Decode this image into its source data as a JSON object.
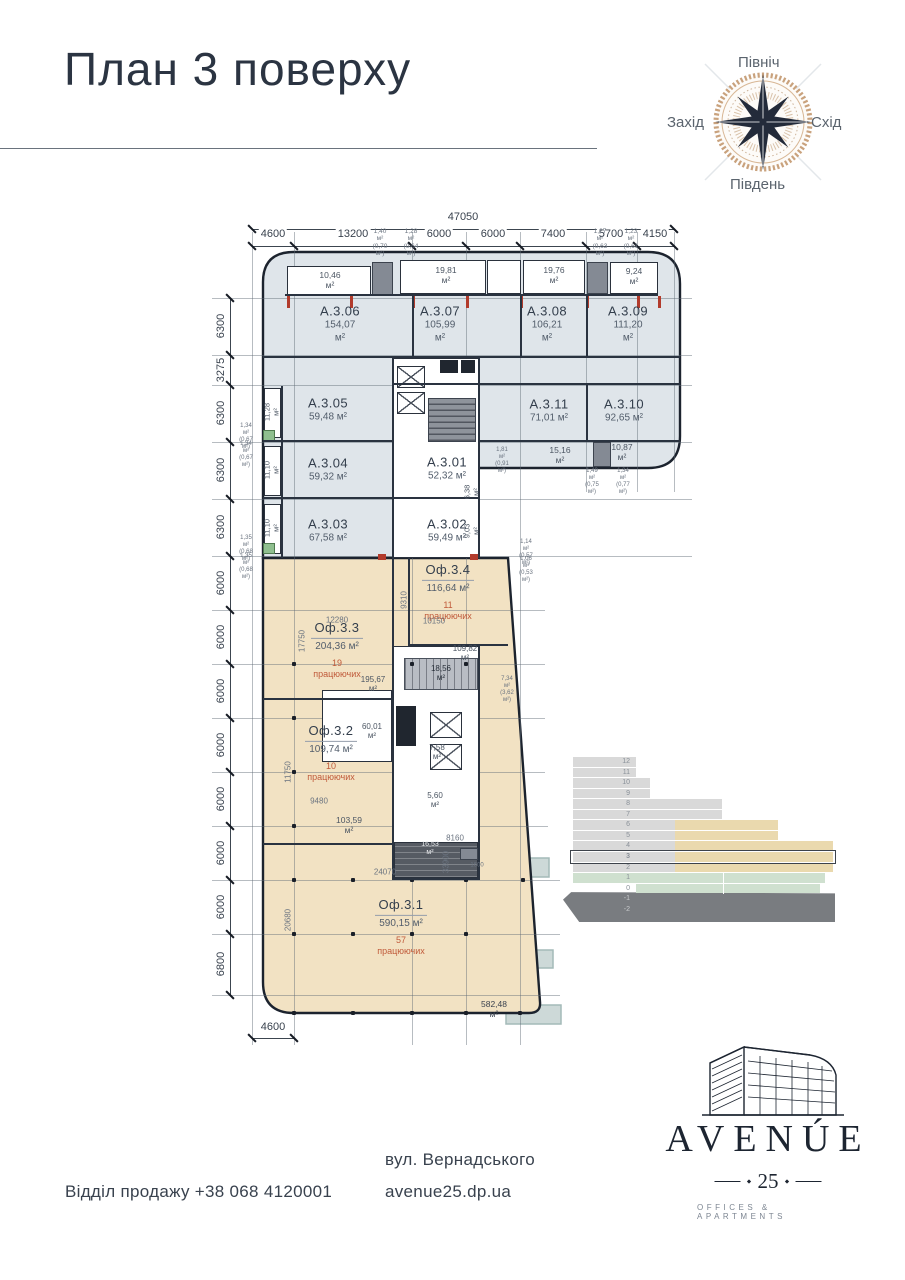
{
  "title": "План 3 поверху",
  "compass": {
    "north": "Північ",
    "south": "Південь",
    "west": "Захід",
    "east": "Схід"
  },
  "plan": {
    "total_width": "47050",
    "top_dims": [
      "4600",
      "13200",
      "6000",
      "6000",
      "7400",
      "5700",
      "4150"
    ],
    "left_dims": [
      "6300",
      "3275",
      "6300",
      "6300",
      "6300",
      "6000",
      "6000",
      "6000",
      "6000",
      "6000",
      "6000",
      "6000",
      "6800"
    ],
    "bottom_dim": "4600",
    "units": [
      {
        "id": "a306",
        "name": "А.3.06",
        "area": "154,07 м²"
      },
      {
        "id": "a307",
        "name": "А.3.07",
        "area": "105,99 м²"
      },
      {
        "id": "a308",
        "name": "А.3.08",
        "area": "106,21 м²"
      },
      {
        "id": "a309",
        "name": "А.3.09",
        "area": "111,20 м²"
      },
      {
        "id": "a305",
        "name": "А.3.05",
        "area": "59,48 м²"
      },
      {
        "id": "a311",
        "name": "А.3.11",
        "area": "71,01 м²"
      },
      {
        "id": "a310",
        "name": "А.3.10",
        "area": "92,65 м²"
      },
      {
        "id": "a304",
        "name": "А.3.04",
        "area": "59,32 м²"
      },
      {
        "id": "a301",
        "name": "А.3.01",
        "area": "52,32 м²"
      },
      {
        "id": "a303",
        "name": "А.3.03",
        "area": "67,58 м²"
      },
      {
        "id": "a302",
        "name": "А.3.02",
        "area": "59,49 м²"
      },
      {
        "id": "of34",
        "name": "Оф.3.4",
        "area": "116,64 м²",
        "workers": "11 працюючих"
      },
      {
        "id": "of33",
        "name": "Оф.3.3",
        "area": "204,36 м²",
        "workers": "19 працюючих"
      },
      {
        "id": "of32",
        "name": "Оф.3.2",
        "area": "109,74 м²",
        "workers": "10 працюючих"
      },
      {
        "id": "of31",
        "name": "Оф.3.1",
        "area": "590,15 м²",
        "workers": "57 працюючих"
      }
    ],
    "annotations": [
      {
        "id": "b1046",
        "text": "10,46 м²"
      },
      {
        "id": "b1981",
        "text": "19,81 м²"
      },
      {
        "id": "b1976",
        "text": "19,76 м²"
      },
      {
        "id": "b924",
        "text": "9,24 м²"
      },
      {
        "id": "t140",
        "text": "1,40 м²\n(0,70 м²)"
      },
      {
        "id": "t128",
        "text": "1,28 м²\n(0,64 м²)"
      },
      {
        "id": "t127",
        "text": "1,27 м²\n(0,63 м²)"
      },
      {
        "id": "t123",
        "text": "1,23 м²\n(0,61 м²)"
      },
      {
        "id": "v1128",
        "text": "11,28 м²"
      },
      {
        "id": "v1110a",
        "text": "11,10 м²"
      },
      {
        "id": "v1110b",
        "text": "11,10 м²"
      },
      {
        "id": "t134a",
        "text": "1,34 м²\n(0,67 м²)"
      },
      {
        "id": "t134b",
        "text": "1,34 м²\n(0,67 м²)"
      },
      {
        "id": "t135a",
        "text": "1,35 м²\n(0,68 м²)"
      },
      {
        "id": "t135b",
        "text": "1,35 м²\n(0,68 м²)"
      },
      {
        "id": "t181",
        "text": "1,81 м²\n(0,91 м²)"
      },
      {
        "id": "s1516",
        "text": "15,16 м²"
      },
      {
        "id": "s1087",
        "text": "10,87 м²"
      },
      {
        "id": "t149",
        "text": "1,49 м²\n(0,75 м²)"
      },
      {
        "id": "t134c",
        "text": "1,34 м²\n(0,77 м²)"
      },
      {
        "id": "v638",
        "text": "6,38 м²"
      },
      {
        "id": "v903",
        "text": "9,03 м²"
      },
      {
        "id": "t114",
        "text": "1,14 м²\n(0,57 м²)"
      },
      {
        "id": "t106",
        "text": "1,06 м²\n(0,53 м²)"
      },
      {
        "id": "d9310",
        "text": "9310"
      },
      {
        "id": "d12280",
        "text": "12280"
      },
      {
        "id": "d10150",
        "text": "10150"
      },
      {
        "id": "d17750",
        "text": "17750"
      },
      {
        "id": "r10982",
        "text": "109,82 м²"
      },
      {
        "id": "r1856",
        "text": "18,56 м²"
      },
      {
        "id": "r19567",
        "text": "195,67 м²"
      },
      {
        "id": "t734",
        "text": "7,34 м²\n(3,62 м²)"
      },
      {
        "id": "r6001",
        "text": "60,01 м²"
      },
      {
        "id": "r758",
        "text": "7,58 м²"
      },
      {
        "id": "d11750",
        "text": "11750"
      },
      {
        "id": "r560",
        "text": "5,60 м²"
      },
      {
        "id": "d9480",
        "text": "9480"
      },
      {
        "id": "r10359",
        "text": "103,59 м²"
      },
      {
        "id": "r1653",
        "text": "16,53 м²"
      },
      {
        "id": "d8160",
        "text": "8160"
      },
      {
        "id": "d1600",
        "text": "1600"
      },
      {
        "id": "d24070",
        "text": "24070"
      },
      {
        "id": "d33900",
        "text": "33900"
      },
      {
        "id": "d20680",
        "text": "20680"
      },
      {
        "id": "r58248",
        "text": "582,48 м²"
      }
    ]
  },
  "elevation": {
    "floor_labels": [
      "12",
      "11",
      "10",
      "9",
      "8",
      "7",
      "6",
      "5",
      "4",
      "3",
      "2",
      "1",
      "0",
      "-1",
      "-2"
    ],
    "highlighted_floor": "3"
  },
  "colors": {
    "apartments_fill": "#dfe5ea",
    "offices_fill": "#f2e2c3",
    "workers_red": "#c05a3a",
    "terrace_teal": "#cdd9d8",
    "elev_grey": "#d9d9d9",
    "elev_beige": "#ead9ae",
    "elev_green": "#cfe0cf"
  },
  "footer": {
    "phone": "Відділ продажу +38 068 4120001",
    "street": "вул. Вернадського",
    "site": "avenue25.dp.ua"
  },
  "logo": {
    "name": "AVENÚE",
    "number": "25",
    "tagline": "OFFICES & APARTMENTS"
  }
}
